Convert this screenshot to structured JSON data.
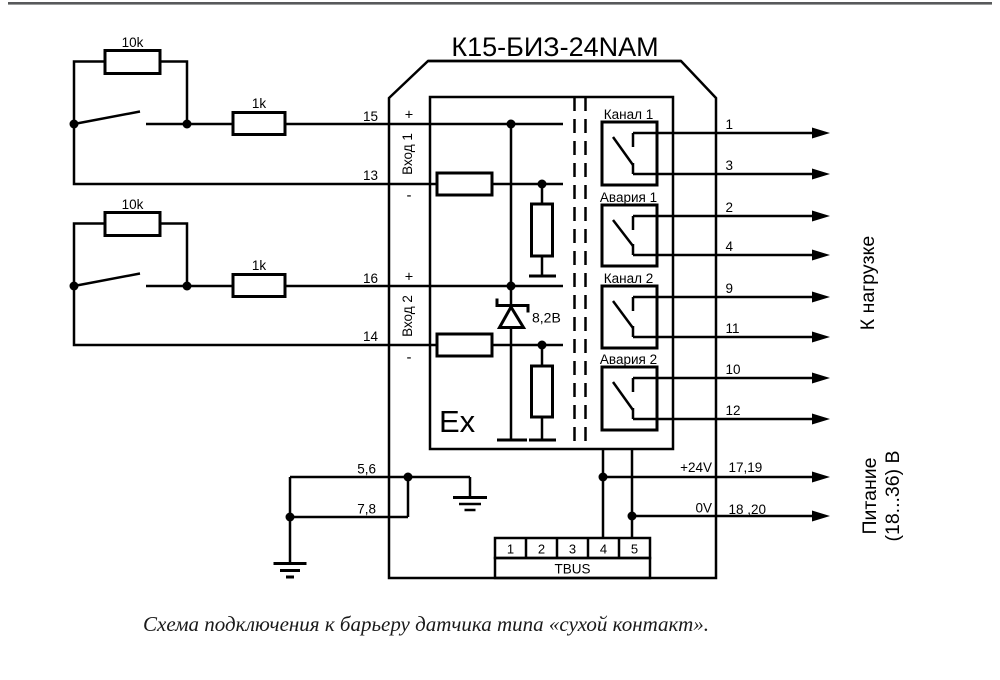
{
  "page": {
    "rule_color": "#58595b",
    "caption": "Схема подключения к барьеру датчика типа «сухой контакт»."
  },
  "device": {
    "title": "К15-БИЗ-24NAM",
    "ex_zone_label": "Ex",
    "zener_voltage": "8,2В",
    "inputs": [
      {
        "label": "Вход 1",
        "plus": "+",
        "minus": "-",
        "pin_plus": "15",
        "pin_minus": "13"
      },
      {
        "label": "Вход 2",
        "plus": "+",
        "minus": "-",
        "pin_plus": "16",
        "pin_minus": "14"
      }
    ],
    "relays": [
      {
        "label": "Канал 1",
        "pin_top": "1",
        "pin_bottom": "3"
      },
      {
        "label": "Авария 1",
        "pin_top": "2",
        "pin_bottom": "4"
      },
      {
        "label": "Канал 2",
        "pin_top": "9",
        "pin_bottom": "11"
      },
      {
        "label": "Авария 2",
        "pin_top": "10",
        "pin_bottom": "12"
      }
    ],
    "power": {
      "plus_label": "+24V",
      "plus_pins": "17,19",
      "zero_label": "0V",
      "zero_pins": "18 ,20"
    },
    "ground": {
      "pins_top": "5,6",
      "pins_bottom": "7,8"
    },
    "tbus": {
      "label": "TBUS",
      "cells": [
        "1",
        "2",
        "3",
        "4",
        "5"
      ]
    }
  },
  "external": {
    "bypass_resistor": "10k",
    "series_resistor": "1k",
    "load_label": "К нагрузке",
    "supply_line1": "Питание",
    "supply_line2": "(18...36) В"
  }
}
